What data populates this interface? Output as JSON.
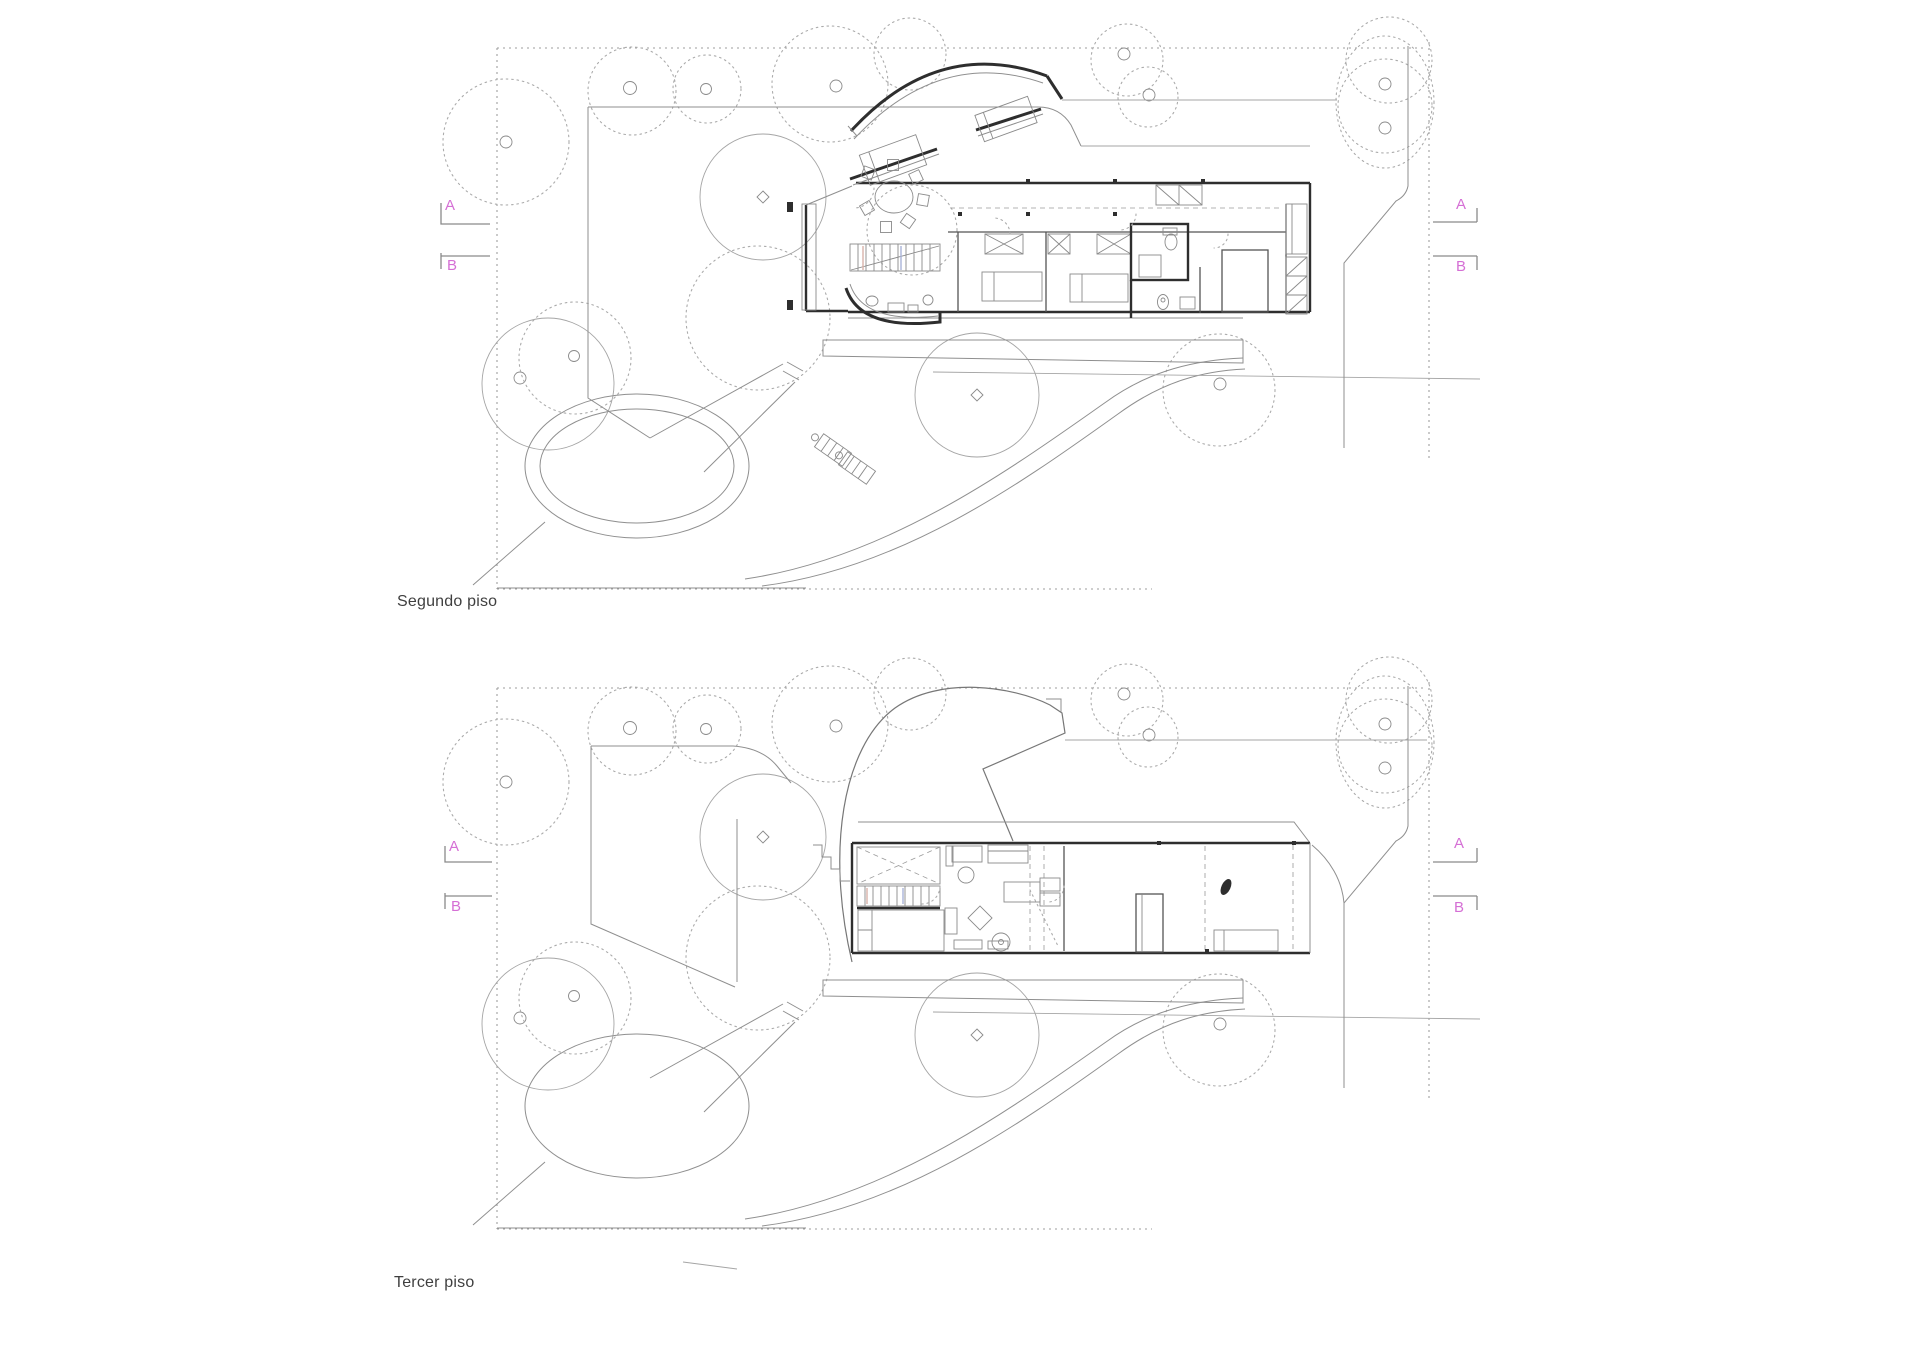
{
  "sheet": {
    "background": "#ffffff"
  },
  "colors": {
    "marker": "#d56fd5",
    "line": "#8f8f8f",
    "wall": "#2e2e2e",
    "label": "#3f3f3f"
  },
  "plans": [
    {
      "label": "Segundo piso",
      "section_markers": [
        {
          "letter": "A",
          "side": "left"
        },
        {
          "letter": "B",
          "side": "left"
        },
        {
          "letter": "A",
          "side": "right"
        },
        {
          "letter": "B",
          "side": "right"
        }
      ]
    },
    {
      "label": "Tercer piso",
      "section_markers": [
        {
          "letter": "A",
          "side": "left"
        },
        {
          "letter": "B",
          "side": "left"
        },
        {
          "letter": "A",
          "side": "right"
        },
        {
          "letter": "B",
          "side": "right"
        }
      ]
    }
  ]
}
